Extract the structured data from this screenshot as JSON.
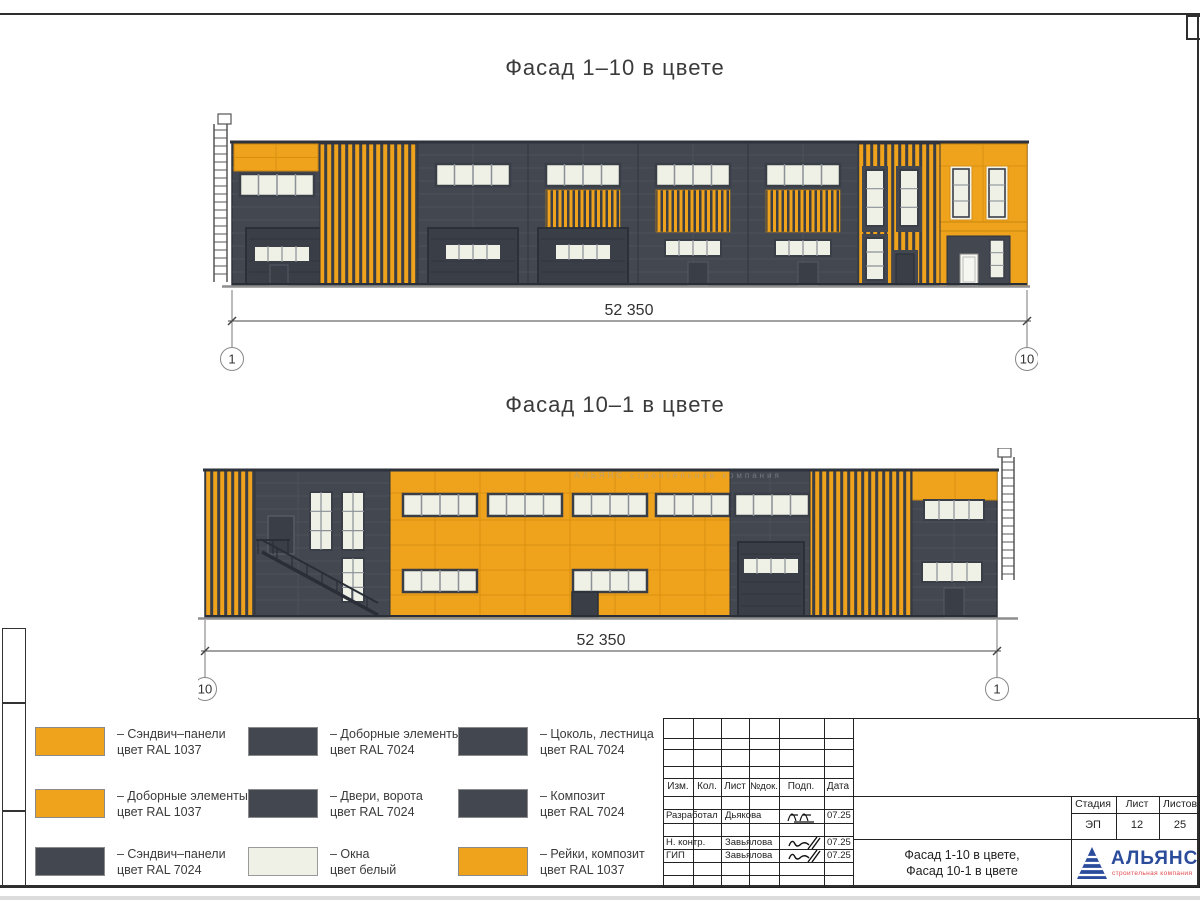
{
  "colors": {
    "ral1037": "#EFA21C",
    "ral7024": "#434750",
    "door": "#3A3E47",
    "window": "#EFF1E6",
    "seam_orange": "#D8910F",
    "seam_dark": "#4C505A",
    "ground": "#8E8E8E",
    "logo_blue": "#2B4C9B",
    "logo_red": "#E2474B"
  },
  "facade1": {
    "title": "Фасад 1–10 в цвете",
    "dimension": "52 350",
    "axis_left": "1",
    "axis_right": "10"
  },
  "facade2": {
    "title": "Фасад 10–1 в цвете",
    "dimension": "52 350",
    "axis_left": "10",
    "axis_right": "1",
    "watermark": "АЛЬЯНС   строительная компания"
  },
  "legend": {
    "items": [
      {
        "swatch": "ral1037",
        "line1": "– Сэндвич–панели",
        "line2": "цвет RAL 1037"
      },
      {
        "swatch": "ral1037",
        "line1": "– Доборные элементы",
        "line2": "цвет RAL 1037"
      },
      {
        "swatch": "ral7024",
        "line1": "– Сэндвич–панели",
        "line2": "цвет RAL 7024"
      },
      {
        "swatch": "ral7024",
        "line1": "– Доборные элементы",
        "line2": "цвет RAL 7024"
      },
      {
        "swatch": "ral7024",
        "line1": "– Двери, ворота",
        "line2": "цвет RAL 7024"
      },
      {
        "swatch": "window",
        "line1": "– Окна",
        "line2": "цвет белый"
      },
      {
        "swatch": "ral7024",
        "line1": "– Цоколь, лестница",
        "line2": "цвет RAL 7024"
      },
      {
        "swatch": "ral7024",
        "line1": "– Композит",
        "line2": "цвет RAL 7024"
      },
      {
        "swatch": "ral1037",
        "line1": "– Рейки, композит",
        "line2": "цвет RAL 1037"
      }
    ]
  },
  "title_block": {
    "headers": [
      "Изм.",
      "Кол.",
      "Лист",
      "№док.",
      "Подп.",
      "Дата"
    ],
    "rows": [
      {
        "role": "Разработал",
        "name": "Дьякова",
        "date": "07.25"
      },
      {
        "role": "Н. контр.",
        "name": "Завьялова",
        "date": "07.25"
      },
      {
        "role": "ГИП",
        "name": "Завьялова",
        "date": "07.25"
      }
    ],
    "stage_label": "Стадия",
    "sheet_label": "Лист",
    "sheets_label": "Листов",
    "stage_value": "ЭП",
    "sheet_value": "12",
    "sheets_value": "25",
    "sheet_title_line1": "Фасад 1-10 в цвете,",
    "sheet_title_line2": "Фасад 10-1 в цвете",
    "logo_name": "АЛЬЯНС",
    "logo_subtitle": "строительная компания"
  }
}
